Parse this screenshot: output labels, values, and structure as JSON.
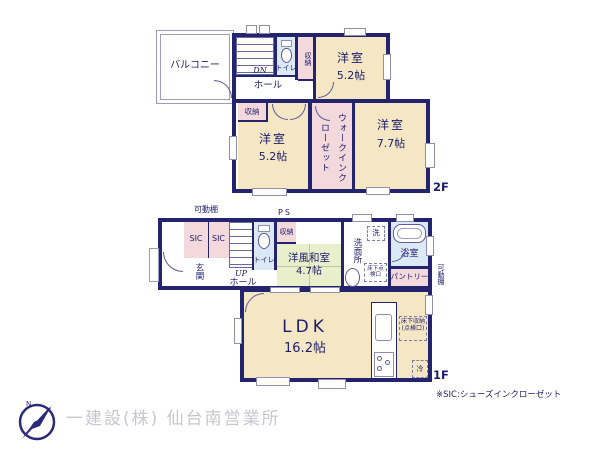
{
  "palette": {
    "wall": "#24246e",
    "room": "#f5e7c3",
    "closet": "#f3d9dc",
    "wet": "#dbe9f6",
    "tatami": "#e9eecb",
    "text": "#1c1c6e",
    "muted": "#c7c7ce"
  },
  "f2": {
    "floor_label": "2F",
    "balcony": "バルコニー",
    "hall": "ホール",
    "dn": "DN",
    "toilet": "トイレ",
    "closet_a": "収納",
    "closet_b": "収納",
    "room1_name": "洋室",
    "room1_size": "5.2帖",
    "room2_name": "洋室",
    "room2_size": "5.2帖",
    "room3_name": "洋室",
    "room3_size": "7.7帖",
    "wic": "ウォークインクローゼット"
  },
  "f1": {
    "floor_label": "1F",
    "shelf_top": "可動棚",
    "ps": "PS",
    "sic_left": "SIC",
    "sic_right": "SIC",
    "genkan": "玄関",
    "up": "UP",
    "hall": "ホール",
    "toilet": "トイレ",
    "closet": "収納",
    "washitsu_name": "洋風和室",
    "washitsu_size": "4.7帖",
    "washer": "洗",
    "senmenjo": "洗面所",
    "bath": "浴室",
    "pantry": "パントリー",
    "shelf_right": "可動棚",
    "underfloor_hatch": "床下点検口",
    "ldk_name": "LDK",
    "ldk_size": "16.2帖",
    "underfloor_storage": "床下収納(点検口)",
    "fridge": "冷"
  },
  "footer": {
    "sic_note": "※SIC:シューズインクローゼット",
    "company": "一建設(株) 仙台南営業所",
    "compass_n": "N"
  }
}
